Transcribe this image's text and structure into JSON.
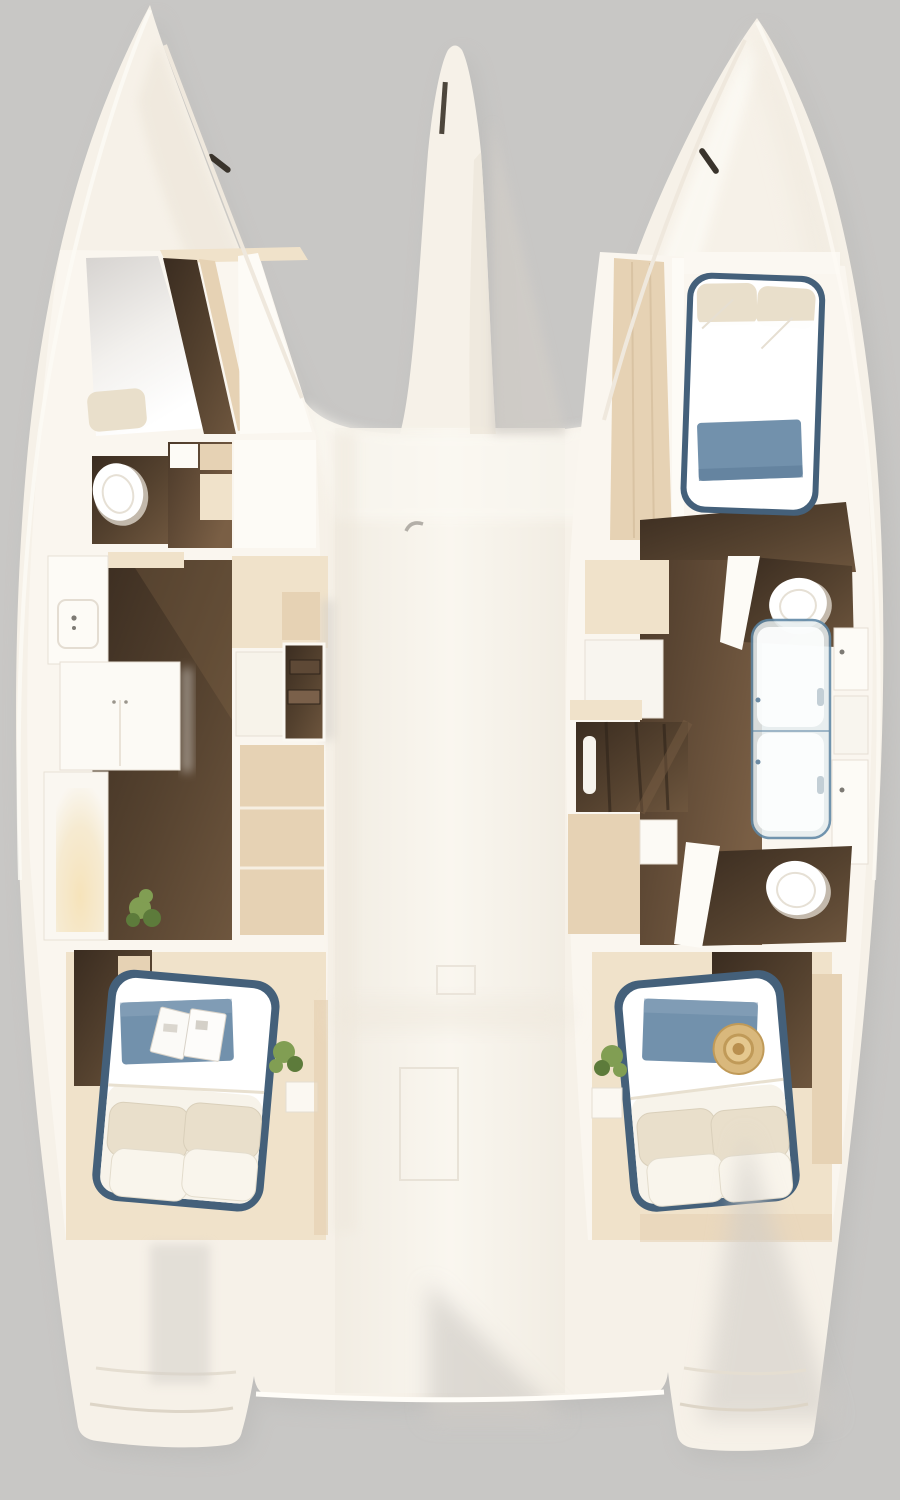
{
  "meta": {
    "title": "Catamaran interior layout - top-down 3D render",
    "view": "overhead floor plan",
    "canvas": {
      "width": 900,
      "height": 1500
    },
    "visible_text": "none"
  },
  "palette": {
    "bg": "#c8c7c5",
    "boatShadow": "#b4b3b1",
    "hull": "#f6f1e8",
    "hullBright": "#fcfaf4",
    "hullShade": "#eee7db",
    "deckMid": "#f8f4ec",
    "wall": "#faf6ef",
    "wallWhite": "#fdfbf6",
    "wood": "#463628",
    "woodMid": "#5e4936",
    "woodLight": "#7a604a",
    "beige": "#e6d2b4",
    "beigeLight": "#f0e2ca",
    "beigeDark": "#d7c1a0",
    "navy": "#44607a",
    "linen": "#f7f3ea",
    "linenShade": "#e8e0d0",
    "pillow": "#e9dfcb",
    "blueThrow": "#7291ac",
    "blueThrowLight": "#8aa4ba",
    "green": "#819e53",
    "greenDark": "#5d7b3b",
    "glass": "#e6edef",
    "glassEdge": "#5d86a4",
    "toilet": "#ffffff",
    "lamp": "#f6e3bd",
    "hat": "#d9b87c",
    "hatEdge": "#c09a58",
    "cleat": "#3a342c",
    "softShadow": "#d2cec8"
  },
  "vessel": {
    "kind": "sailing catamaran",
    "sections": {
      "port_hull": {
        "label": "Port hull (left)",
        "features": [
          {
            "id": "port-forward-cabin",
            "label": "Forward cabin with berth panel and pillow"
          },
          {
            "id": "port-head",
            "label": "Head (toilet compartment)"
          },
          {
            "id": "port-galley",
            "label": "Galley with counter, island, pantry and plant"
          },
          {
            "id": "port-aft-cabin",
            "label": "Aft double cabin: bed, blue throw, magazine, pillows, plant"
          }
        ]
      },
      "starboard_hull": {
        "label": "Starboard hull (right)",
        "features": [
          {
            "id": "stbd-forward-cabin",
            "label": "Forward double cabin: bed with blue throw, wardrobe"
          },
          {
            "id": "stbd-bathroom",
            "label": "Bathroom: two toilets, glass shower, twin vanities"
          },
          {
            "id": "stbd-aft-cabin",
            "label": "Aft double cabin: bed, blue throw, straw hat, plant"
          }
        ]
      },
      "center": {
        "label": "Bridge deck",
        "features": [
          {
            "id": "center-nacelle",
            "label": "Central bow nacelle"
          },
          {
            "id": "port-companionway",
            "label": "Port companionway stairs"
          },
          {
            "id": "stbd-companionway",
            "label": "Starboard companionway stairs"
          },
          {
            "id": "deck-hatches",
            "label": "Deck hatch seams"
          },
          {
            "id": "stern-platform",
            "label": "Aft deck edge and twin transoms"
          }
        ]
      }
    }
  }
}
